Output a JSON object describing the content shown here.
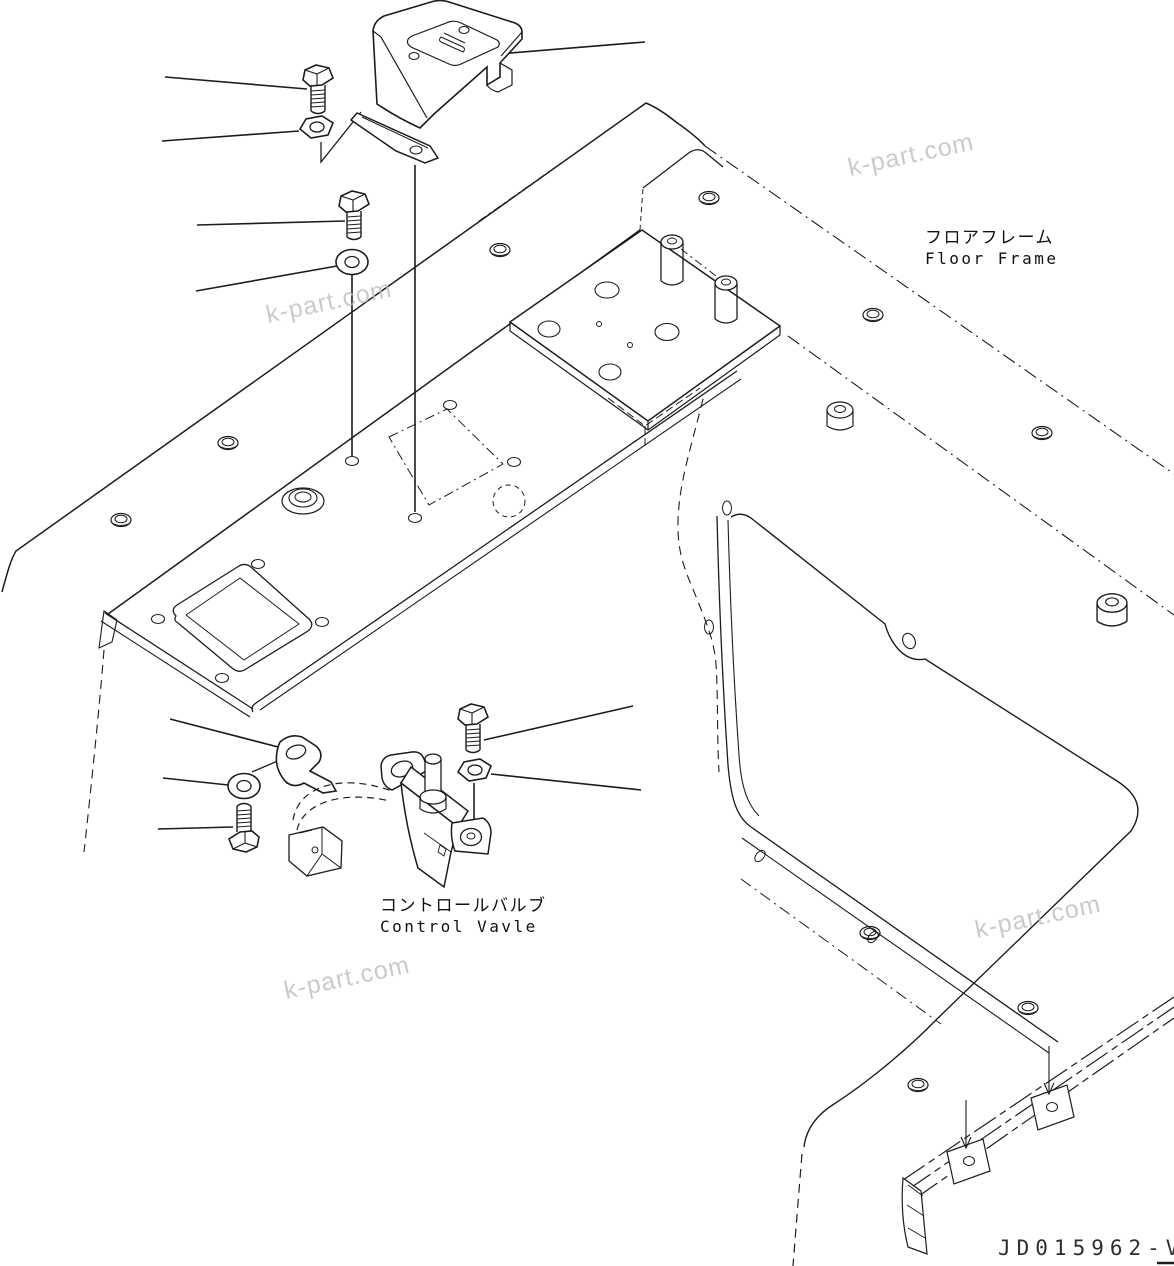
{
  "page": {
    "background": "#ffffff",
    "line_color": "#1c1c1c",
    "watermark_color": "#bdbdbd"
  },
  "labels": {
    "floor_frame_jp": "フロアフレーム",
    "floor_frame_en": "Floor Frame",
    "control_valve_jp": "コントロールバルブ",
    "control_valve_en": "Control Vavle",
    "drawing_number": "JD015962-V"
  },
  "watermark": {
    "text": "k-part.com"
  }
}
